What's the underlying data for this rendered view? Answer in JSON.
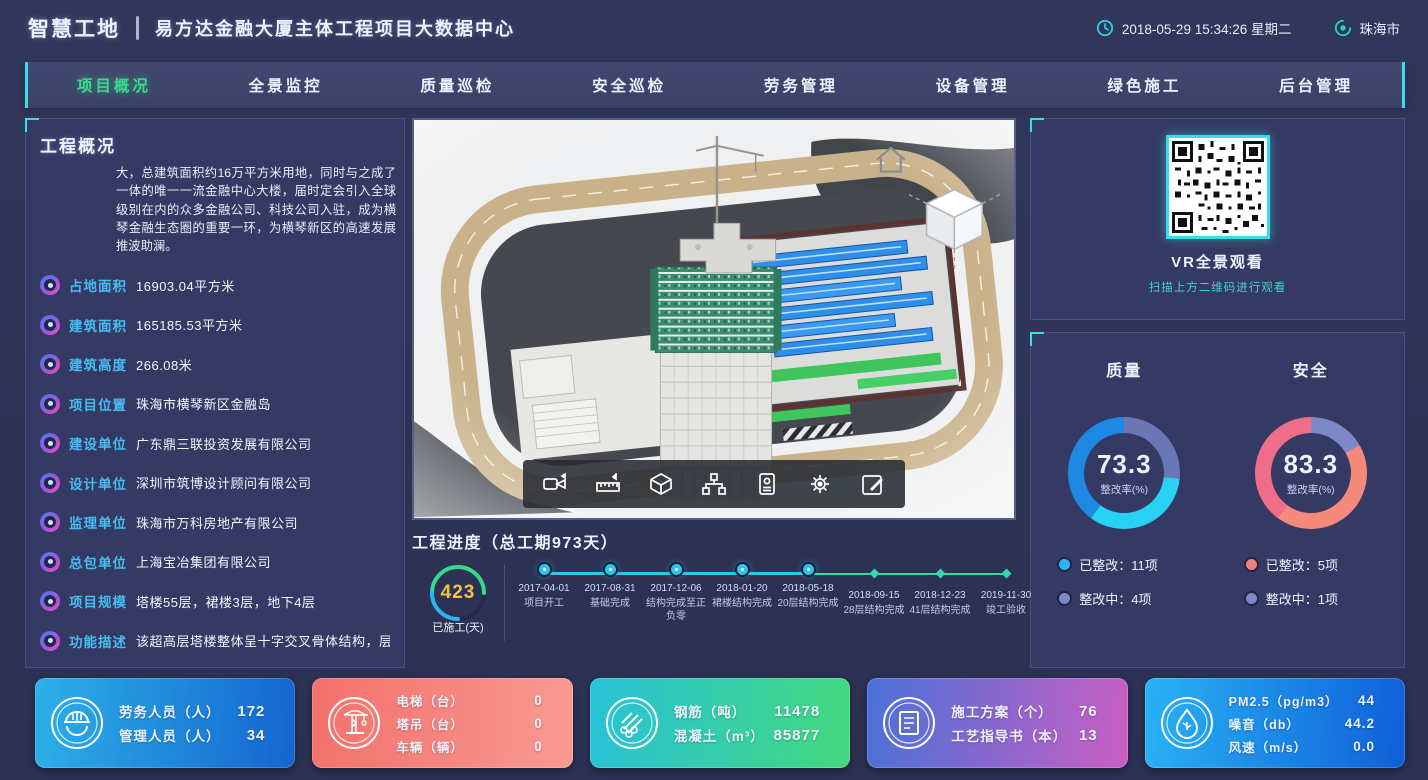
{
  "header": {
    "brand": "智慧工地",
    "title": "易方达金融大厦主体工程项目大数据中心",
    "datetime": "2018-05-29 15:34:26 星期二",
    "city": "珠海市",
    "clock_icon": "clock-icon",
    "location_icon": "location-icon"
  },
  "nav": {
    "tabs": [
      {
        "label": "项目概况",
        "active": true
      },
      {
        "label": "全景监控",
        "active": false
      },
      {
        "label": "质量巡检",
        "active": false
      },
      {
        "label": "安全巡检",
        "active": false
      },
      {
        "label": "劳务管理",
        "active": false
      },
      {
        "label": "设备管理",
        "active": false
      },
      {
        "label": "绿色施工",
        "active": false
      },
      {
        "label": "后台管理",
        "active": false
      }
    ]
  },
  "overview": {
    "title": "工程概况",
    "description": "大，总建筑面积约16万平方米用地，同时与之成了一体的唯一一流金融中心大楼，届时定会引入全球级别在内的众多金融公司、科技公司入驻，成为横琴金融生态圈的重要一环，为横琴新区的高速发展推波助澜。",
    "items": [
      {
        "label": "占地面积",
        "value": "16903.04平方米"
      },
      {
        "label": "建筑面积",
        "value": "165185.53平方米"
      },
      {
        "label": "建筑高度",
        "value": "266.08米"
      },
      {
        "label": "项目位置",
        "value": "珠海市横琴新区金融岛"
      },
      {
        "label": "建设单位",
        "value": "广东鼎三联投资发展有限公司"
      },
      {
        "label": "设计单位",
        "value": "深圳市筑博设计顾问有限公司"
      },
      {
        "label": "监理单位",
        "value": "珠海市万科房地产有限公司"
      },
      {
        "label": "总包单位",
        "value": "上海宝冶集团有限公司"
      },
      {
        "label": "项目规模",
        "value": "塔楼55层，裙楼3层，地下4层"
      },
      {
        "label": "功能描述",
        "value": "该超高层塔楼整体呈十字交叉骨体结构，层高为"
      }
    ]
  },
  "model": {
    "toolbar_icons": [
      "video-camera-icon",
      "measure-icon",
      "cube-icon",
      "structure-icon",
      "id-card-icon",
      "gear-icon",
      "edit-icon"
    ]
  },
  "progress": {
    "title": "工程进度（总工期973天）",
    "done_days": "423",
    "done_label": "已施工(天)",
    "milestones": [
      {
        "date": "2017-04-01",
        "label": "项目开工",
        "state": "done"
      },
      {
        "date": "2017-08-31",
        "label": "基础完成",
        "state": "done"
      },
      {
        "date": "2017-12-06",
        "label": "结构完成至正负零",
        "state": "done"
      },
      {
        "date": "2018-01-20",
        "label": "裙楼结构完成",
        "state": "done"
      },
      {
        "date": "2018-05-18",
        "label": "20层结构完成",
        "state": "done"
      },
      {
        "date": "2018-09-15",
        "label": "28层结构完成",
        "state": "pending"
      },
      {
        "date": "2018-12-23",
        "label": "41层结构完成",
        "state": "pending"
      },
      {
        "date": "2019-11-30",
        "label": "竣工验收",
        "state": "pending"
      }
    ]
  },
  "vr": {
    "title": "VR全景观看",
    "subtitle": "扫描上方二维码进行观看"
  },
  "inspection": {
    "quality": {
      "title": "质量",
      "value": "73.3",
      "percent": 73.3,
      "gauge_label": "整改率(%)",
      "gauge_css": "conic-gradient(from 0deg, #6b77b4 0% 26.7%, #29d2f5 26.7% 60%, #1e88e5 60% 100%)",
      "legend": [
        {
          "label": "已整改：11项",
          "color": "#29b6f6"
        },
        {
          "label": "整改中：4项",
          "color": "#7d88c6"
        }
      ]
    },
    "safety": {
      "title": "安全",
      "value": "83.3",
      "percent": 83.3,
      "gauge_label": "整改率(%)",
      "gauge_css": "conic-gradient(from 0deg, #7d88c6 0% 16.7%, #f58a7c 16.7% 60%, #ef6d88 60% 100%)",
      "legend": [
        {
          "label": "已整改：5项",
          "color": "#f2817e"
        },
        {
          "label": "整改中：1项",
          "color": "#7d88c6"
        }
      ]
    }
  },
  "cards": [
    {
      "icon": "worker-helmet-icon",
      "gradient": "linear-gradient(95deg,#2cb0e8,#1565d0)",
      "rows": [
        {
          "label": "劳务人员（人）",
          "value": "172"
        },
        {
          "label": "管理人员（人）",
          "value": "34"
        }
      ]
    },
    {
      "icon": "tower-crane-icon",
      "gradient": "linear-gradient(95deg,#f3716b,#f89a92)",
      "rows": [
        {
          "label": "电梯（台）",
          "value": "0"
        },
        {
          "label": "塔吊（台）",
          "value": "0"
        },
        {
          "label": "车辆（辆）",
          "value": "0"
        }
      ]
    },
    {
      "icon": "rebar-icon",
      "gradient": "linear-gradient(95deg,#28c2d8,#43d97c)",
      "rows": [
        {
          "label": "钢筋（吨）",
          "value": "11478"
        },
        {
          "label": "混凝土（m³）",
          "value": "85877"
        }
      ]
    },
    {
      "icon": "document-icon",
      "gradient": "linear-gradient(95deg,#4a71d8,#c95fc4)",
      "rows": [
        {
          "label": "施工方案（个）",
          "value": "76"
        },
        {
          "label": "工艺指导书（本）",
          "value": "13"
        }
      ]
    },
    {
      "icon": "eco-drop-icon",
      "gradient": "linear-gradient(95deg,#29b2f5,#0f5fd8)",
      "rows": [
        {
          "label": "PM2.5（pg/m3）",
          "value": "44"
        },
        {
          "label": "噪音（db）",
          "value": "44.2"
        },
        {
          "label": "风速（m/s）",
          "value": "0.0"
        }
      ]
    }
  ]
}
